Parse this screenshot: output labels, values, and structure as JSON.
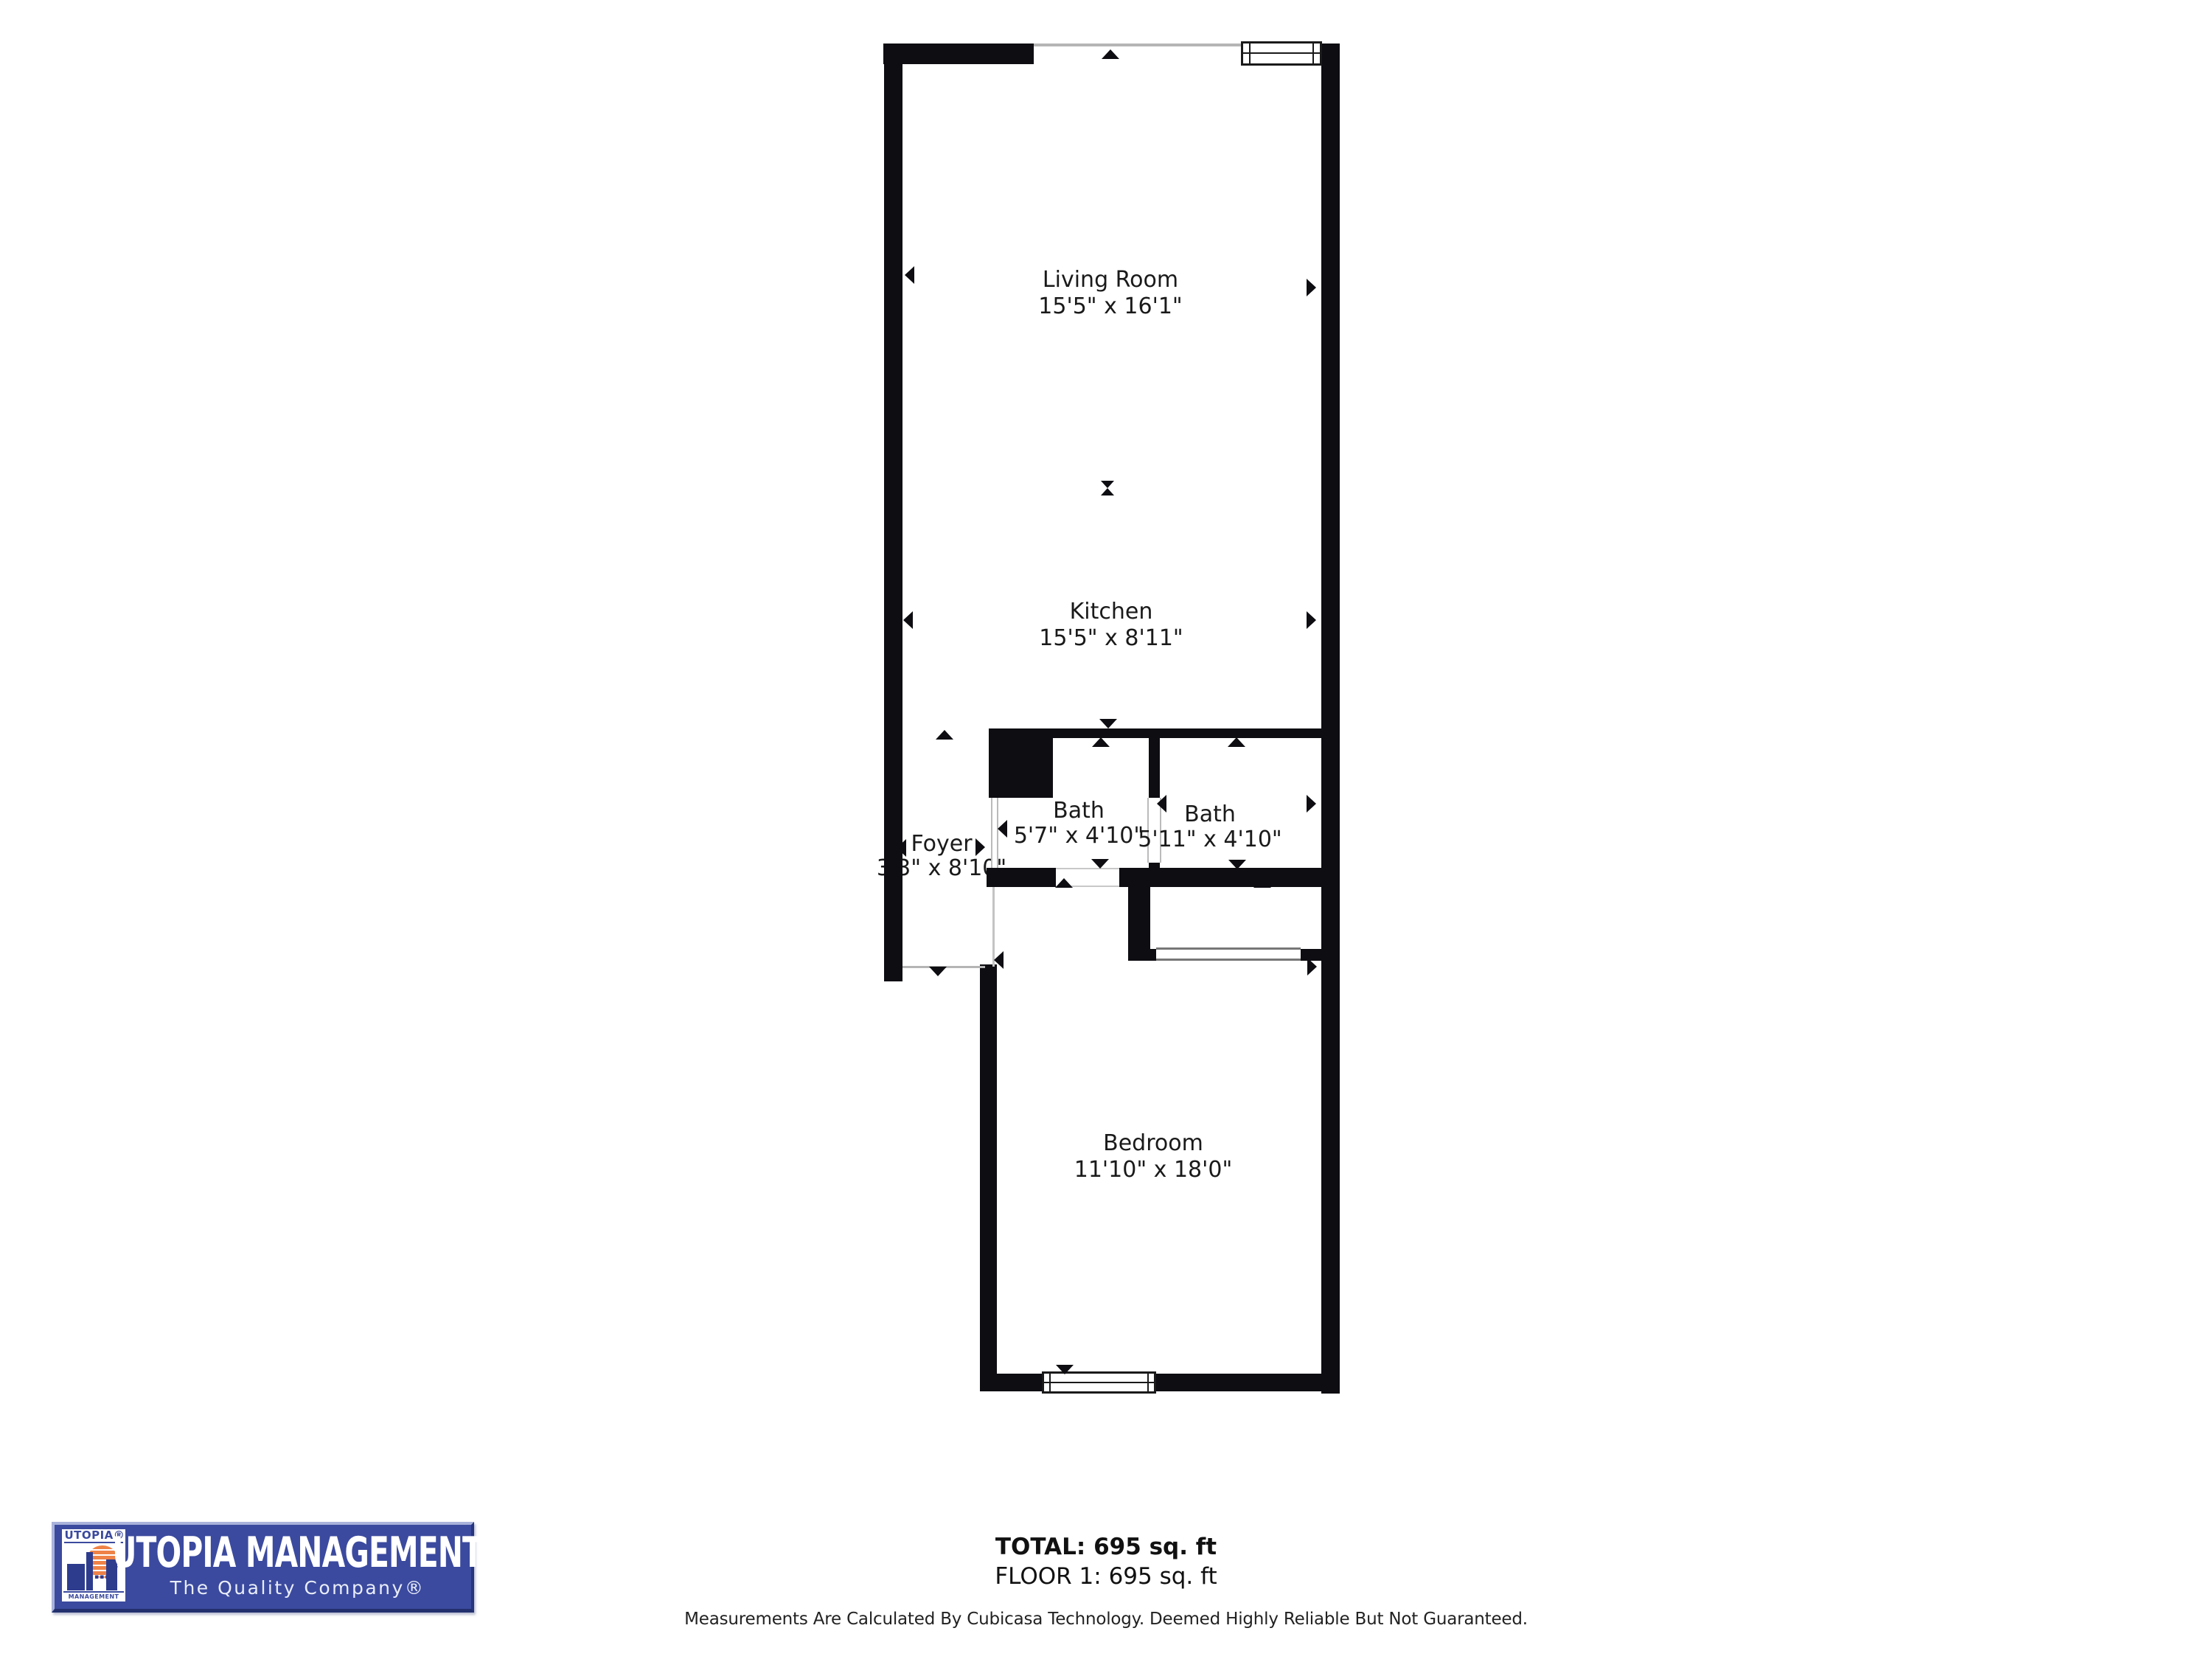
{
  "rooms": [
    {
      "name": "Living Room",
      "dims": "15'5\" x 16'1\""
    },
    {
      "name": "Kitchen",
      "dims": "15'5\" x 8'11\""
    },
    {
      "name": "Bath",
      "dims": "5'7\" x 4'10\""
    },
    {
      "name": "Bath",
      "dims": "5'11\" x 4'10\""
    },
    {
      "name": "Foyer",
      "dims": "3'3\" x 8'10\""
    },
    {
      "name": "Bedroom",
      "dims": "11'10\" x 18'0\""
    }
  ],
  "summary": {
    "total": "TOTAL: 695 sq. ft",
    "floor": "FLOOR 1: 695 sq. ft",
    "disclaimer": "Measurements Are Calculated By Cubicasa Technology. Deemed Highly Reliable But Not Guaranteed."
  },
  "logo": {
    "brand": "UTOPIA MANAGEMENT",
    "tagline": "The Quality Company®",
    "badge_top": "UTOPIA®",
    "badge_bottom": "MANAGEMENT",
    "colors": {
      "blue": "#3B4A9E",
      "light_blue_bevel": "#A9B3DA",
      "orange": "#EE8247",
      "wall": "#0D0D12"
    }
  }
}
